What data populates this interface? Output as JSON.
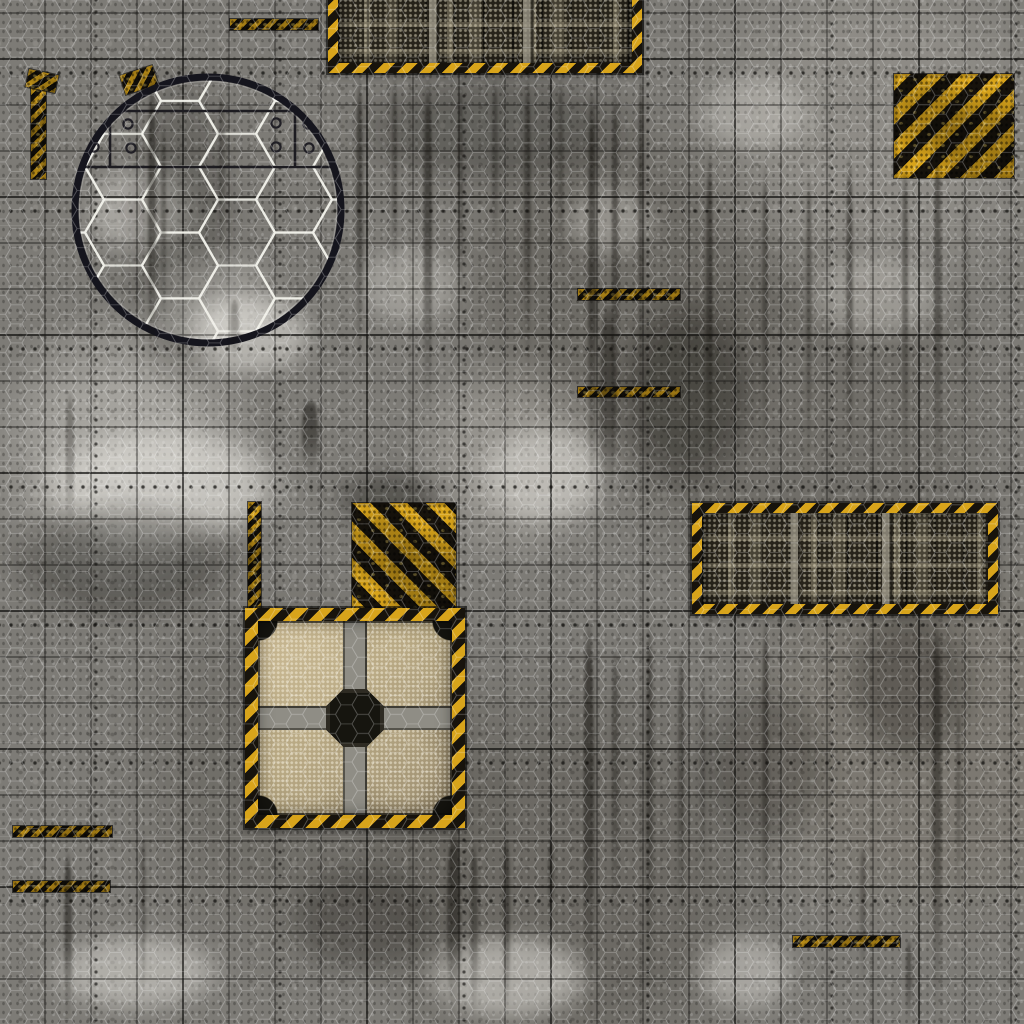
{
  "meta": {
    "title": "Sci-fi industrial battle mat texture",
    "description": "Grungy gray riveted metal-plate wargaming mat with square grid, hex wire mesh overlay, hazard-striped panels, hex porthole window and grime streaks",
    "grid_cell_px": 46,
    "size_px": 1024
  },
  "palette": {
    "base_gray": "#7d7b76",
    "hazard_yellow": "#d8a41b",
    "hazard_black": "#17130c",
    "panel_dark": "#28241b",
    "tan": "#a39470",
    "tan_light": "#c4b38d",
    "tan_dark": "#6b5f49",
    "steel": "#8f8d85",
    "ring": "#15151d"
  },
  "objects": {
    "hex-porthole": {
      "x": 66,
      "y": 68,
      "w": 284,
      "h": 284
    },
    "top-tech-panel": {
      "x": 328,
      "y": -17,
      "w": 314,
      "h": 90
    },
    "right-tech-panel": {
      "x": 692,
      "y": 503,
      "w": 306,
      "h": 111
    },
    "hazard-square-top-right": {
      "x": 894,
      "y": 74,
      "w": 120,
      "h": 104,
      "dir": "135deg",
      "sw": 12
    },
    "hazard-square-mid": {
      "x": 352,
      "y": 503,
      "w": 104,
      "h": 110,
      "dir": "45deg",
      "sw": 13
    },
    "cargo-quilt-panel": {
      "x": 245,
      "y": 608,
      "w": 220,
      "h": 220
    },
    "hazard-strip-mid-left": {
      "x": 248,
      "y": 502,
      "w": 13,
      "h": 110,
      "dir": "135deg",
      "sw": 5
    },
    "hazard-strip-left-edge": {
      "x": 31,
      "y": 74,
      "w": 15,
      "h": 105,
      "dir": "135deg",
      "sw": 5
    }
  },
  "hazard_bars": [
    {
      "x": 230,
      "y": 19,
      "w": 88,
      "h": 11
    },
    {
      "x": 578,
      "y": 289,
      "w": 102,
      "h": 11
    },
    {
      "x": 578,
      "y": 387,
      "w": 102,
      "h": 10
    },
    {
      "x": 13,
      "y": 826,
      "w": 99,
      "h": 11
    },
    {
      "x": 13,
      "y": 881,
      "w": 97,
      "h": 11
    },
    {
      "x": 793,
      "y": 936,
      "w": 107,
      "h": 11
    },
    {
      "x": 122,
      "y": 70,
      "w": 34,
      "h": 20,
      "r": -18
    },
    {
      "x": 27,
      "y": 72,
      "w": 30,
      "h": 18,
      "r": 12
    }
  ],
  "streaks": [
    {
      "x": 148,
      "y": 76,
      "w": 8,
      "h": 300,
      "o": 0.5
    },
    {
      "x": 161,
      "y": 120,
      "w": 5,
      "h": 210,
      "o": 0.35
    },
    {
      "x": 218,
      "y": 88,
      "w": 7,
      "h": 170,
      "o": 0.3
    },
    {
      "x": 230,
      "y": 298,
      "w": 9,
      "h": 62,
      "o": 0.3
    },
    {
      "x": 356,
      "y": 72,
      "w": 7,
      "h": 300,
      "o": 0.5
    },
    {
      "x": 392,
      "y": 72,
      "w": 5,
      "h": 220,
      "o": 0.4
    },
    {
      "x": 424,
      "y": 72,
      "w": 8,
      "h": 350,
      "o": 0.55
    },
    {
      "x": 458,
      "y": 72,
      "w": 5,
      "h": 260,
      "o": 0.4
    },
    {
      "x": 492,
      "y": 76,
      "w": 6,
      "h": 180,
      "o": 0.35
    },
    {
      "x": 524,
      "y": 72,
      "w": 7,
      "h": 300,
      "o": 0.45
    },
    {
      "x": 558,
      "y": 72,
      "w": 5,
      "h": 210,
      "o": 0.35
    },
    {
      "x": 588,
      "y": 80,
      "w": 8,
      "h": 430,
      "o": 0.55
    },
    {
      "x": 612,
      "y": 76,
      "w": 6,
      "h": 390,
      "o": 0.5
    },
    {
      "x": 638,
      "y": 72,
      "w": 6,
      "h": 310,
      "o": 0.4
    },
    {
      "x": 600,
      "y": 300,
      "w": 16,
      "h": 220,
      "o": 0.45
    },
    {
      "x": 706,
      "y": 150,
      "w": 7,
      "h": 330,
      "o": 0.45
    },
    {
      "x": 762,
      "y": 160,
      "w": 6,
      "h": 320,
      "o": 0.4
    },
    {
      "x": 806,
      "y": 170,
      "w": 6,
      "h": 300,
      "o": 0.35
    },
    {
      "x": 846,
      "y": 150,
      "w": 7,
      "h": 330,
      "o": 0.45
    },
    {
      "x": 902,
      "y": 160,
      "w": 6,
      "h": 320,
      "o": 0.4
    },
    {
      "x": 934,
      "y": 140,
      "w": 7,
      "h": 350,
      "o": 0.45
    },
    {
      "x": 963,
      "y": 180,
      "w": 5,
      "h": 250,
      "o": 0.3
    },
    {
      "x": 66,
      "y": 390,
      "w": 8,
      "h": 140,
      "o": 0.3
    },
    {
      "x": 302,
      "y": 398,
      "w": 16,
      "h": 74,
      "o": 0.5
    },
    {
      "x": 64,
      "y": 850,
      "w": 8,
      "h": 174,
      "o": 0.5
    },
    {
      "x": 140,
      "y": 830,
      "w": 6,
      "h": 170,
      "o": 0.3
    },
    {
      "x": 447,
      "y": 828,
      "w": 14,
      "h": 190,
      "o": 0.55
    },
    {
      "x": 470,
      "y": 840,
      "w": 8,
      "h": 180,
      "o": 0.4
    },
    {
      "x": 503,
      "y": 832,
      "w": 7,
      "h": 185,
      "o": 0.45
    },
    {
      "x": 548,
      "y": 836,
      "w": 6,
      "h": 90,
      "o": 0.35
    },
    {
      "x": 584,
      "y": 614,
      "w": 10,
      "h": 410,
      "o": 0.55
    },
    {
      "x": 612,
      "y": 640,
      "w": 6,
      "h": 300,
      "o": 0.4
    },
    {
      "x": 646,
      "y": 614,
      "w": 7,
      "h": 390,
      "o": 0.45
    },
    {
      "x": 678,
      "y": 640,
      "w": 6,
      "h": 300,
      "o": 0.4
    },
    {
      "x": 700,
      "y": 660,
      "w": 5,
      "h": 250,
      "o": 0.3
    },
    {
      "x": 762,
      "y": 614,
      "w": 7,
      "h": 330,
      "o": 0.45
    },
    {
      "x": 860,
      "y": 840,
      "w": 6,
      "h": 150,
      "o": 0.3
    },
    {
      "x": 932,
      "y": 614,
      "w": 9,
      "h": 410,
      "o": 0.5
    },
    {
      "x": 956,
      "y": 700,
      "w": 5,
      "h": 210,
      "o": 0.3
    },
    {
      "x": 906,
      "y": 938,
      "w": 6,
      "h": 86,
      "o": 0.4
    }
  ],
  "light_patches": [
    {
      "x": 28,
      "y": 420,
      "w": 270,
      "h": 130,
      "o": 0.55
    },
    {
      "x": 180,
      "y": 290,
      "w": 140,
      "h": 90,
      "o": 0.5
    },
    {
      "x": 80,
      "y": 160,
      "w": 120,
      "h": 100,
      "o": 0.4
    },
    {
      "x": 470,
      "y": 420,
      "w": 150,
      "h": 110,
      "o": 0.45
    },
    {
      "x": 420,
      "y": 930,
      "w": 180,
      "h": 95,
      "o": 0.5
    },
    {
      "x": 40,
      "y": 930,
      "w": 190,
      "h": 85,
      "o": 0.45
    },
    {
      "x": 690,
      "y": 930,
      "w": 110,
      "h": 85,
      "o": 0.4
    },
    {
      "x": 800,
      "y": 250,
      "w": 150,
      "h": 95,
      "o": 0.3
    },
    {
      "x": 690,
      "y": 70,
      "w": 130,
      "h": 85,
      "o": 0.3
    },
    {
      "x": 350,
      "y": 240,
      "w": 120,
      "h": 90,
      "o": 0.3
    },
    {
      "x": 560,
      "y": 180,
      "w": 100,
      "h": 80,
      "o": 0.3
    }
  ],
  "stains": [
    {
      "x": 612,
      "y": 290,
      "w": 150,
      "h": 210,
      "o": 0.35
    },
    {
      "x": 0,
      "y": 495,
      "w": 250,
      "h": 130,
      "o": 0.3
    },
    {
      "x": 840,
      "y": 600,
      "w": 140,
      "h": 170,
      "o": 0.28
    },
    {
      "x": 280,
      "y": 860,
      "w": 170,
      "h": 120,
      "o": 0.28
    },
    {
      "x": 690,
      "y": 680,
      "w": 150,
      "h": 170,
      "o": 0.22
    },
    {
      "x": 330,
      "y": 468,
      "w": 120,
      "h": 62,
      "o": 0.35
    },
    {
      "x": 340,
      "y": 70,
      "w": 310,
      "h": 120,
      "o": 0.25
    },
    {
      "x": 120,
      "y": 60,
      "w": 120,
      "h": 330,
      "o": 0.2
    }
  ]
}
